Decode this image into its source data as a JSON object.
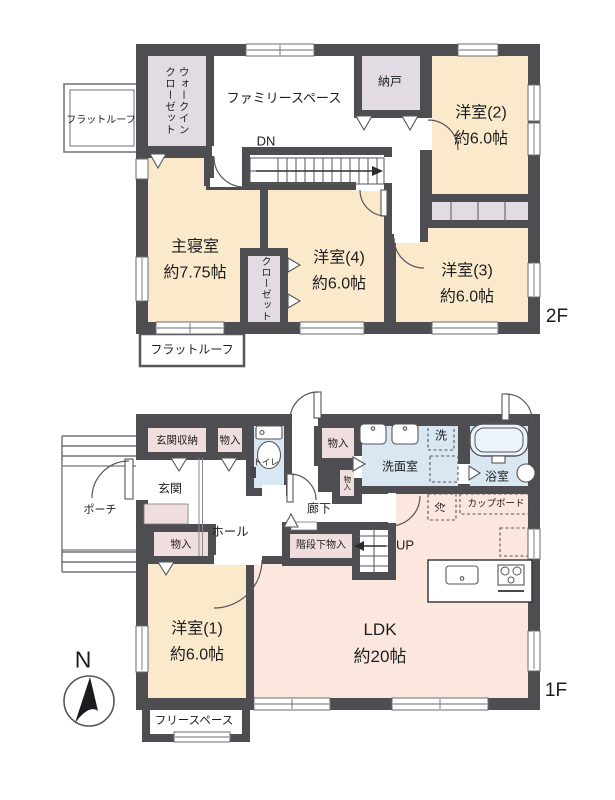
{
  "palette": {
    "wall": "#4e4e52",
    "room_cream": "#faeacb",
    "room_pink": "#fbe7dd",
    "storage_lavender": "#e2dbe3",
    "storage_pink": "#f0dddd",
    "water_blue": "#d8e7f2",
    "cupboard_pink": "#eed8d2",
    "tub_blue": "#edf3fa"
  },
  "floor2": {
    "floor_label": "2F",
    "flat_roof_left": "フラットルーフ",
    "flat_roof_bottom": "フラットルーフ",
    "walk_in_closet_line1": "ウォークイン",
    "walk_in_closet_line2": "クローゼット",
    "family_space": "ファミリースペース",
    "storeroom": "納戸",
    "stairs_down": "DN",
    "room2_name": "洋室(2)",
    "room2_size": "約6.0帖",
    "master_name": "主寝室",
    "master_size": "約7.75帖",
    "closet": "クローゼット",
    "room4_name": "洋室(4)",
    "room4_size": "約6.0帖",
    "room3_name": "洋室(3)",
    "room3_size": "約6.0帖"
  },
  "floor1": {
    "floor_label": "1F",
    "porch": "ポーチ",
    "entrance_storage": "玄関収納",
    "storage_top": "物入",
    "toilet": "トイレ",
    "storage_mid": "物入",
    "storage_small": "物入",
    "washroom": "洗面室",
    "washer": "洗",
    "bathroom": "浴室",
    "entrance": "玄関",
    "hall": "ホール",
    "corridor": "廊下",
    "storage_bottom": "物入",
    "understairs_storage": "階段下物入",
    "stairs_up": "UP",
    "fridge": "冷",
    "cupboard": "カップボード",
    "room1_name": "洋室(1)",
    "room1_size": "約6.0帖",
    "ldk_name": "LDK",
    "ldk_size": "約20帖",
    "free_space": "フリースペース",
    "north": "N"
  }
}
